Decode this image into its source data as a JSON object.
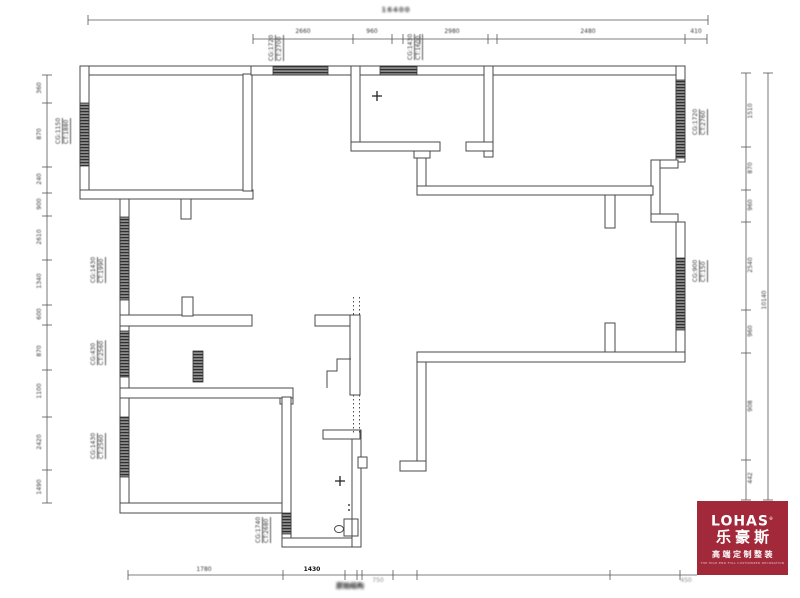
{
  "colors": {
    "wall_line": "#4a4a4a",
    "dim_line": "#555555",
    "text": "#3a3a3a",
    "logo_bg": "#A2293A",
    "logo_fg": "#ffffff"
  },
  "logo": {
    "brand": "LOHAS",
    "reg": "®",
    "brand_cn": "乐豪斯",
    "tagline": "高端定制整装",
    "subline": "THE HIGH-END FULL CUSTOMIZED DECORATION"
  },
  "notes": {
    "top": "16400",
    "bottom": "原始结构"
  },
  "window_labels": [
    {
      "l1": "CG:1150",
      "l2": "CT:1880",
      "x": 63,
      "y": 131
    },
    {
      "l1": "CG:1720",
      "l2": "CT:2700",
      "x": 276,
      "y": 48
    },
    {
      "l1": "CG:1430",
      "l2": "CT:1600",
      "x": 415,
      "y": 47
    },
    {
      "l1": "CG:1720",
      "l2": "CT:2760",
      "x": 700,
      "y": 122
    },
    {
      "l1": "CG:900",
      "l2": "CT:150",
      "x": 700,
      "y": 271
    },
    {
      "l1": "CG:1430",
      "l2": "CT:1990",
      "x": 98,
      "y": 270
    },
    {
      "l1": "CG:430",
      "l2": "CT:2560",
      "x": 98,
      "y": 353
    },
    {
      "l1": "CG:1430",
      "l2": "CT:2560",
      "x": 98,
      "y": 446
    },
    {
      "l1": "CG:1740",
      "l2": "CT:2680",
      "x": 263,
      "y": 530
    }
  ],
  "dim_chains": [
    {
      "name": "top-overall",
      "orient": "h",
      "pos": 20,
      "from": 88,
      "to": 708,
      "ticks": [
        88,
        708
      ]
    },
    {
      "name": "top-detail",
      "orient": "h",
      "pos": 39,
      "from": 253,
      "to": 707,
      "ticks": [
        253,
        353,
        392,
        403,
        420,
        488,
        497,
        685,
        707
      ]
    },
    {
      "name": "left",
      "orient": "v",
      "pos": 47,
      "from": 75,
      "to": 503,
      "ticks": [
        75,
        103,
        167,
        193,
        216,
        260,
        305,
        325,
        370,
        417,
        470,
        503
      ]
    },
    {
      "name": "right-inner",
      "orient": "v",
      "pos": 746,
      "from": 73,
      "to": 500,
      "ticks": [
        73,
        147,
        190,
        222,
        310,
        353,
        460,
        500
      ]
    },
    {
      "name": "right-outer",
      "orient": "v",
      "pos": 768,
      "from": 73,
      "to": 500,
      "ticks": [
        73,
        500
      ]
    },
    {
      "name": "bottom",
      "orient": "h",
      "pos": 575,
      "from": 128,
      "to": 697,
      "ticks": [
        128,
        283,
        345,
        357,
        362,
        393,
        417,
        610,
        680
      ]
    }
  ],
  "dim_numbers": [
    {
      "t": "2660",
      "x": 303,
      "y": 32
    },
    {
      "t": "960",
      "x": 372,
      "y": 32
    },
    {
      "t": "2980",
      "x": 452,
      "y": 32
    },
    {
      "t": "2480",
      "x": 588,
      "y": 32
    },
    {
      "t": "410",
      "x": 696,
      "y": 32
    },
    {
      "t": "360",
      "x": 40,
      "y": 88,
      "rot": true
    },
    {
      "t": "870",
      "x": 40,
      "y": 134,
      "rot": true
    },
    {
      "t": "240",
      "x": 40,
      "y": 179,
      "rot": true
    },
    {
      "t": "900",
      "x": 40,
      "y": 204,
      "rot": true
    },
    {
      "t": "2610",
      "x": 40,
      "y": 237,
      "rot": true
    },
    {
      "t": "1340",
      "x": 40,
      "y": 281,
      "rot": true
    },
    {
      "t": "600",
      "x": 40,
      "y": 314,
      "rot": true
    },
    {
      "t": "870",
      "x": 40,
      "y": 351,
      "rot": true
    },
    {
      "t": "1100",
      "x": 40,
      "y": 391,
      "rot": true
    },
    {
      "t": "2420",
      "x": 40,
      "y": 442,
      "rot": true
    },
    {
      "t": "1490",
      "x": 40,
      "y": 487,
      "rot": true
    },
    {
      "t": "1510",
      "x": 751,
      "y": 111,
      "rot": true
    },
    {
      "t": "870",
      "x": 751,
      "y": 168,
      "rot": true
    },
    {
      "t": "960",
      "x": 751,
      "y": 205,
      "rot": true
    },
    {
      "t": "2540",
      "x": 751,
      "y": 265,
      "rot": true
    },
    {
      "t": "960",
      "x": 751,
      "y": 331,
      "rot": true
    },
    {
      "t": "908",
      "x": 751,
      "y": 406,
      "rot": true
    },
    {
      "t": "442",
      "x": 751,
      "y": 478,
      "rot": true
    },
    {
      "t": "10140",
      "x": 765,
      "y": 300,
      "rot": true
    },
    {
      "t": "1780",
      "x": 204,
      "y": 570
    },
    {
      "t": "1430",
      "x": 312,
      "y": 570,
      "strong": true
    },
    {
      "t": "750",
      "x": 378,
      "y": 581,
      "faint": true
    },
    {
      "t": "450",
      "x": 686,
      "y": 581,
      "faint": true
    }
  ]
}
